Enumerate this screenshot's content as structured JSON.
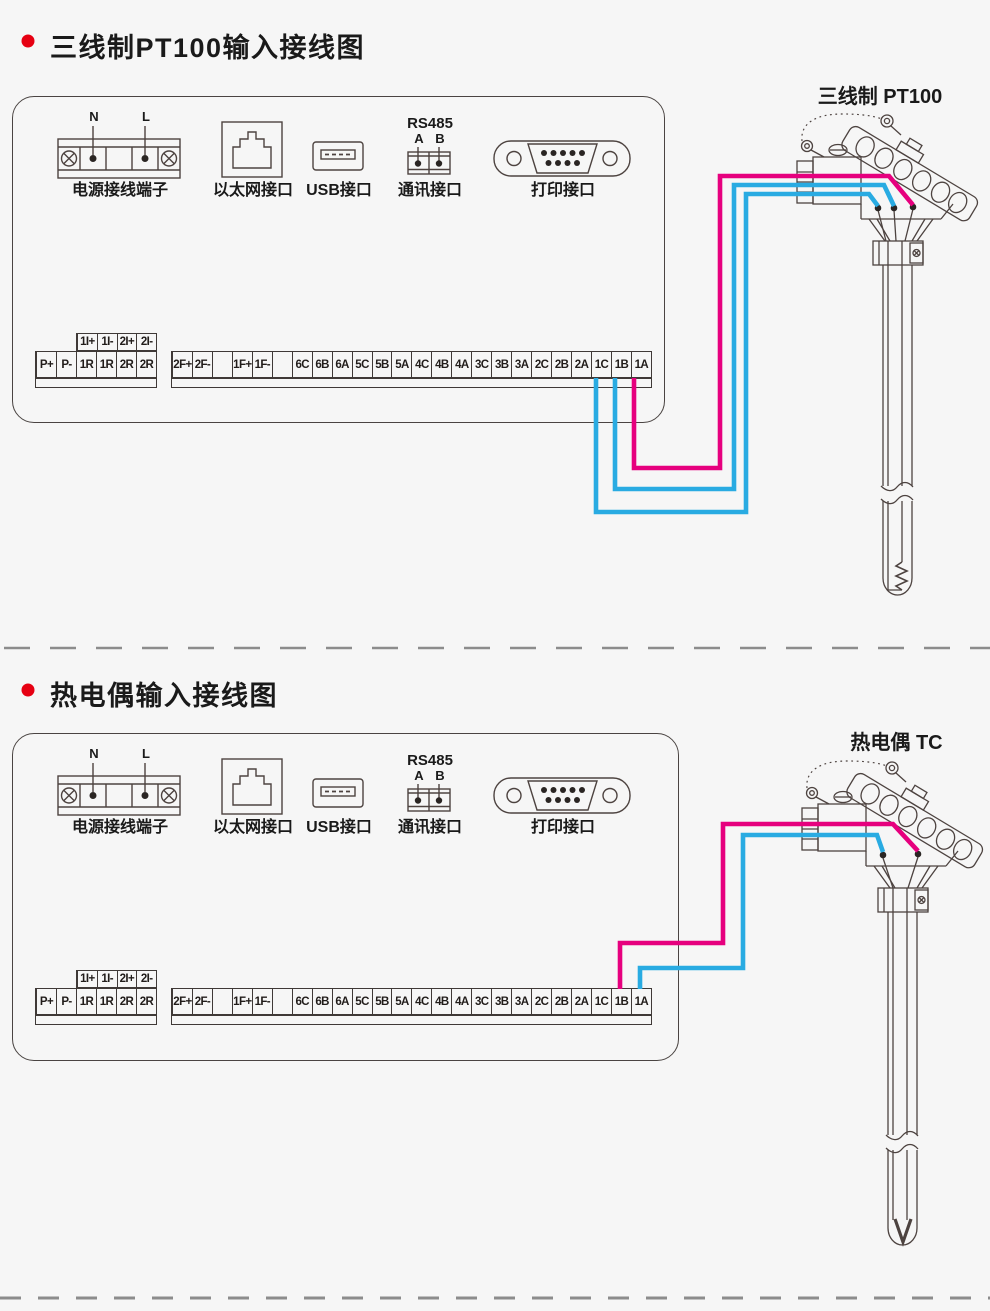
{
  "colors": {
    "wire_magenta": "#e6007e",
    "wire_blue": "#29abe2",
    "line_art": "#4d4340",
    "bullet_red": "#e60012",
    "dash_gray": "#8c8c8c"
  },
  "sections": [
    {
      "title": "三线制PT100输入接线图",
      "probe_label": "三线制 PT100",
      "sensor_type": "pt100",
      "wiring": [
        {
          "terminal": "1A",
          "wire_color": "magenta"
        },
        {
          "terminal": "1B",
          "wire_color": "blue"
        },
        {
          "terminal": "1C",
          "wire_color": "blue"
        }
      ]
    },
    {
      "title": "热电偶输入接线图",
      "probe_label": "热电偶 TC",
      "sensor_type": "thermocouple",
      "wiring": [
        {
          "terminal": "1B",
          "wire_color": "magenta"
        },
        {
          "terminal": "1A",
          "wire_color": "blue"
        }
      ]
    }
  ],
  "panel": {
    "ports": [
      {
        "label": "电源接线端子",
        "pins": [
          "N",
          "L"
        ]
      },
      {
        "label": "以太网接口"
      },
      {
        "label": "USB接口"
      },
      {
        "label": "通讯接口",
        "bus": "RS485",
        "pins": [
          "A",
          "B"
        ]
      },
      {
        "label": "打印接口"
      }
    ],
    "terminal_small": [
      "1I+",
      "1I-",
      "2I+",
      "2I-"
    ],
    "terminal_left": [
      "P+",
      "P-",
      "1R",
      "1R",
      "2R",
      "2R"
    ],
    "terminal_main": [
      "2F+",
      "2F-",
      "",
      "1F+",
      "1F-",
      "",
      "6C",
      "6B",
      "6A",
      "5C",
      "5B",
      "5A",
      "4C",
      "4B",
      "4A",
      "3C",
      "3B",
      "3A",
      "2C",
      "2B",
      "2A",
      "1C",
      "1B",
      "1A"
    ]
  }
}
